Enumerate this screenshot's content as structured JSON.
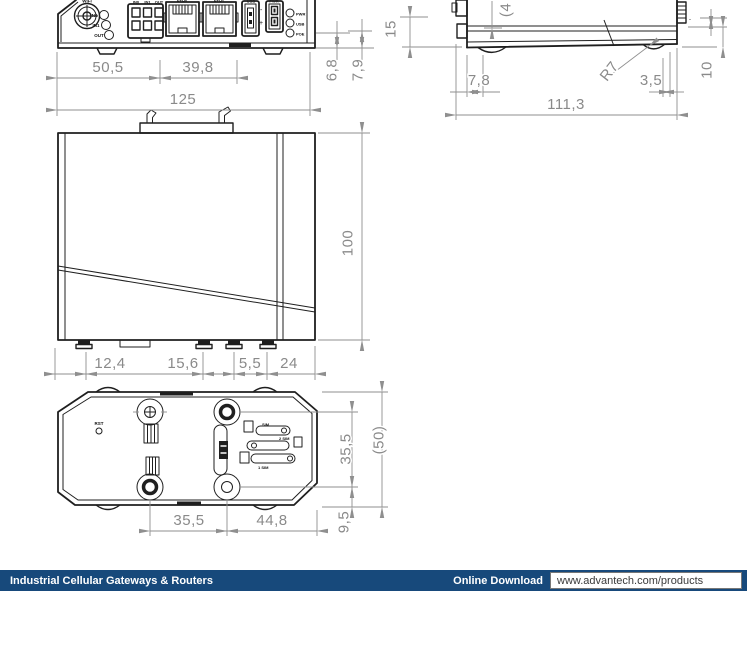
{
  "footer": {
    "category": "Industrial Cellular Gateways & Routers",
    "download_label": "Online Download",
    "url": "www.advantech.com/products",
    "bar_color": "#17497B"
  },
  "front_view": {
    "antenna_label": "WiFi",
    "io_led_labels": [
      "IN0",
      "IN1",
      "OUT"
    ],
    "connector_labels": [
      "IN0",
      "IN1",
      "OUT"
    ],
    "eth0_label": "ETH0",
    "eth1_label": "ETH1",
    "usb_label": "USB",
    "pwr_label": "PWR",
    "led_labels": [
      "PWR",
      "USB",
      "POE"
    ],
    "polarity_minus": "-",
    "polarity_plus": "+",
    "dims": {
      "w1": "50,5",
      "w2": "39,8",
      "w_total": "125",
      "h1": "6,8",
      "h2": "7,9"
    }
  },
  "side_view": {
    "minus_mark": "-",
    "dims": {
      "h_left": "15",
      "h_cut": "(4",
      "d_front": "7,8",
      "radius": "R7",
      "d_rear": "3,5",
      "w_total": "111,3",
      "h_right": "10"
    }
  },
  "left_view": {
    "dims": {
      "height": "100",
      "b1": "12,4",
      "b2": "15,6",
      "b3": "5,5",
      "b4": "24"
    }
  },
  "bottom_view": {
    "reset_label": "RST",
    "sim_labels": [
      "SIM",
      "2 SIM",
      "1 SIM"
    ],
    "dims": {
      "w1": "35,5",
      "w2": "44,8",
      "h1": "35,5",
      "h2": "(50)",
      "h3": "9,5"
    }
  }
}
